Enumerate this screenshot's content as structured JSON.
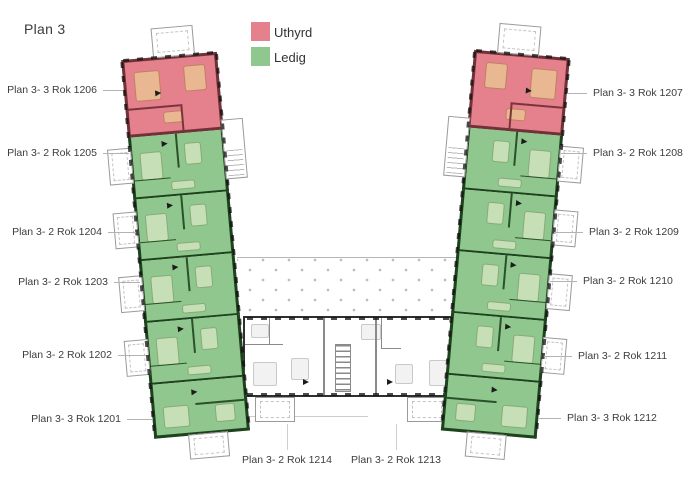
{
  "title": "Plan 3",
  "legend": {
    "items": [
      {
        "label": "Uthyrd",
        "status": "rented",
        "color": "#e5808d"
      },
      {
        "label": "Ledig",
        "status": "available",
        "color": "#90c78e"
      }
    ]
  },
  "floor": {
    "left_wing": [
      {
        "id": "1206",
        "label": "Plan 3- 3 Rok 1206",
        "status": "uthyrd"
      },
      {
        "id": "1205",
        "label": "Plan 3- 2 Rok 1205",
        "status": "ledig"
      },
      {
        "id": "1204",
        "label": "Plan 3- 2 Rok 1204",
        "status": "ledig"
      },
      {
        "id": "1203",
        "label": "Plan 3- 2 Rok 1203",
        "status": "ledig"
      },
      {
        "id": "1202",
        "label": "Plan 3- 2 Rok 1202",
        "status": "ledig"
      },
      {
        "id": "1201",
        "label": "Plan 3- 3 Rok 1201",
        "status": "ledig"
      }
    ],
    "right_wing": [
      {
        "id": "1207",
        "label": "Plan 3- 3 Rok 1207",
        "status": "uthyrd"
      },
      {
        "id": "1208",
        "label": "Plan 3- 2 Rok 1208",
        "status": "ledig"
      },
      {
        "id": "1209",
        "label": "Plan 3- 2 Rok 1209",
        "status": "ledig"
      },
      {
        "id": "1210",
        "label": "Plan 3- 2 Rok 1210",
        "status": "ledig"
      },
      {
        "id": "1211",
        "label": "Plan 3- 2 Rok 1211",
        "status": "ledig"
      },
      {
        "id": "1212",
        "label": "Plan 3- 3 Rok 1212",
        "status": "ledig"
      }
    ],
    "bottom": [
      {
        "id": "1214",
        "label": "Plan 3- 2 Rok 1214",
        "status": "none"
      },
      {
        "id": "1213",
        "label": "Plan 3- 2 Rok 1213",
        "status": "none"
      }
    ]
  },
  "colors": {
    "rented_fill": "#e5808d",
    "rented_wall": "#703238",
    "available_fill": "#90c78e",
    "available_wall": "#1e421e",
    "neutral_wall": "#2f2f2f"
  }
}
